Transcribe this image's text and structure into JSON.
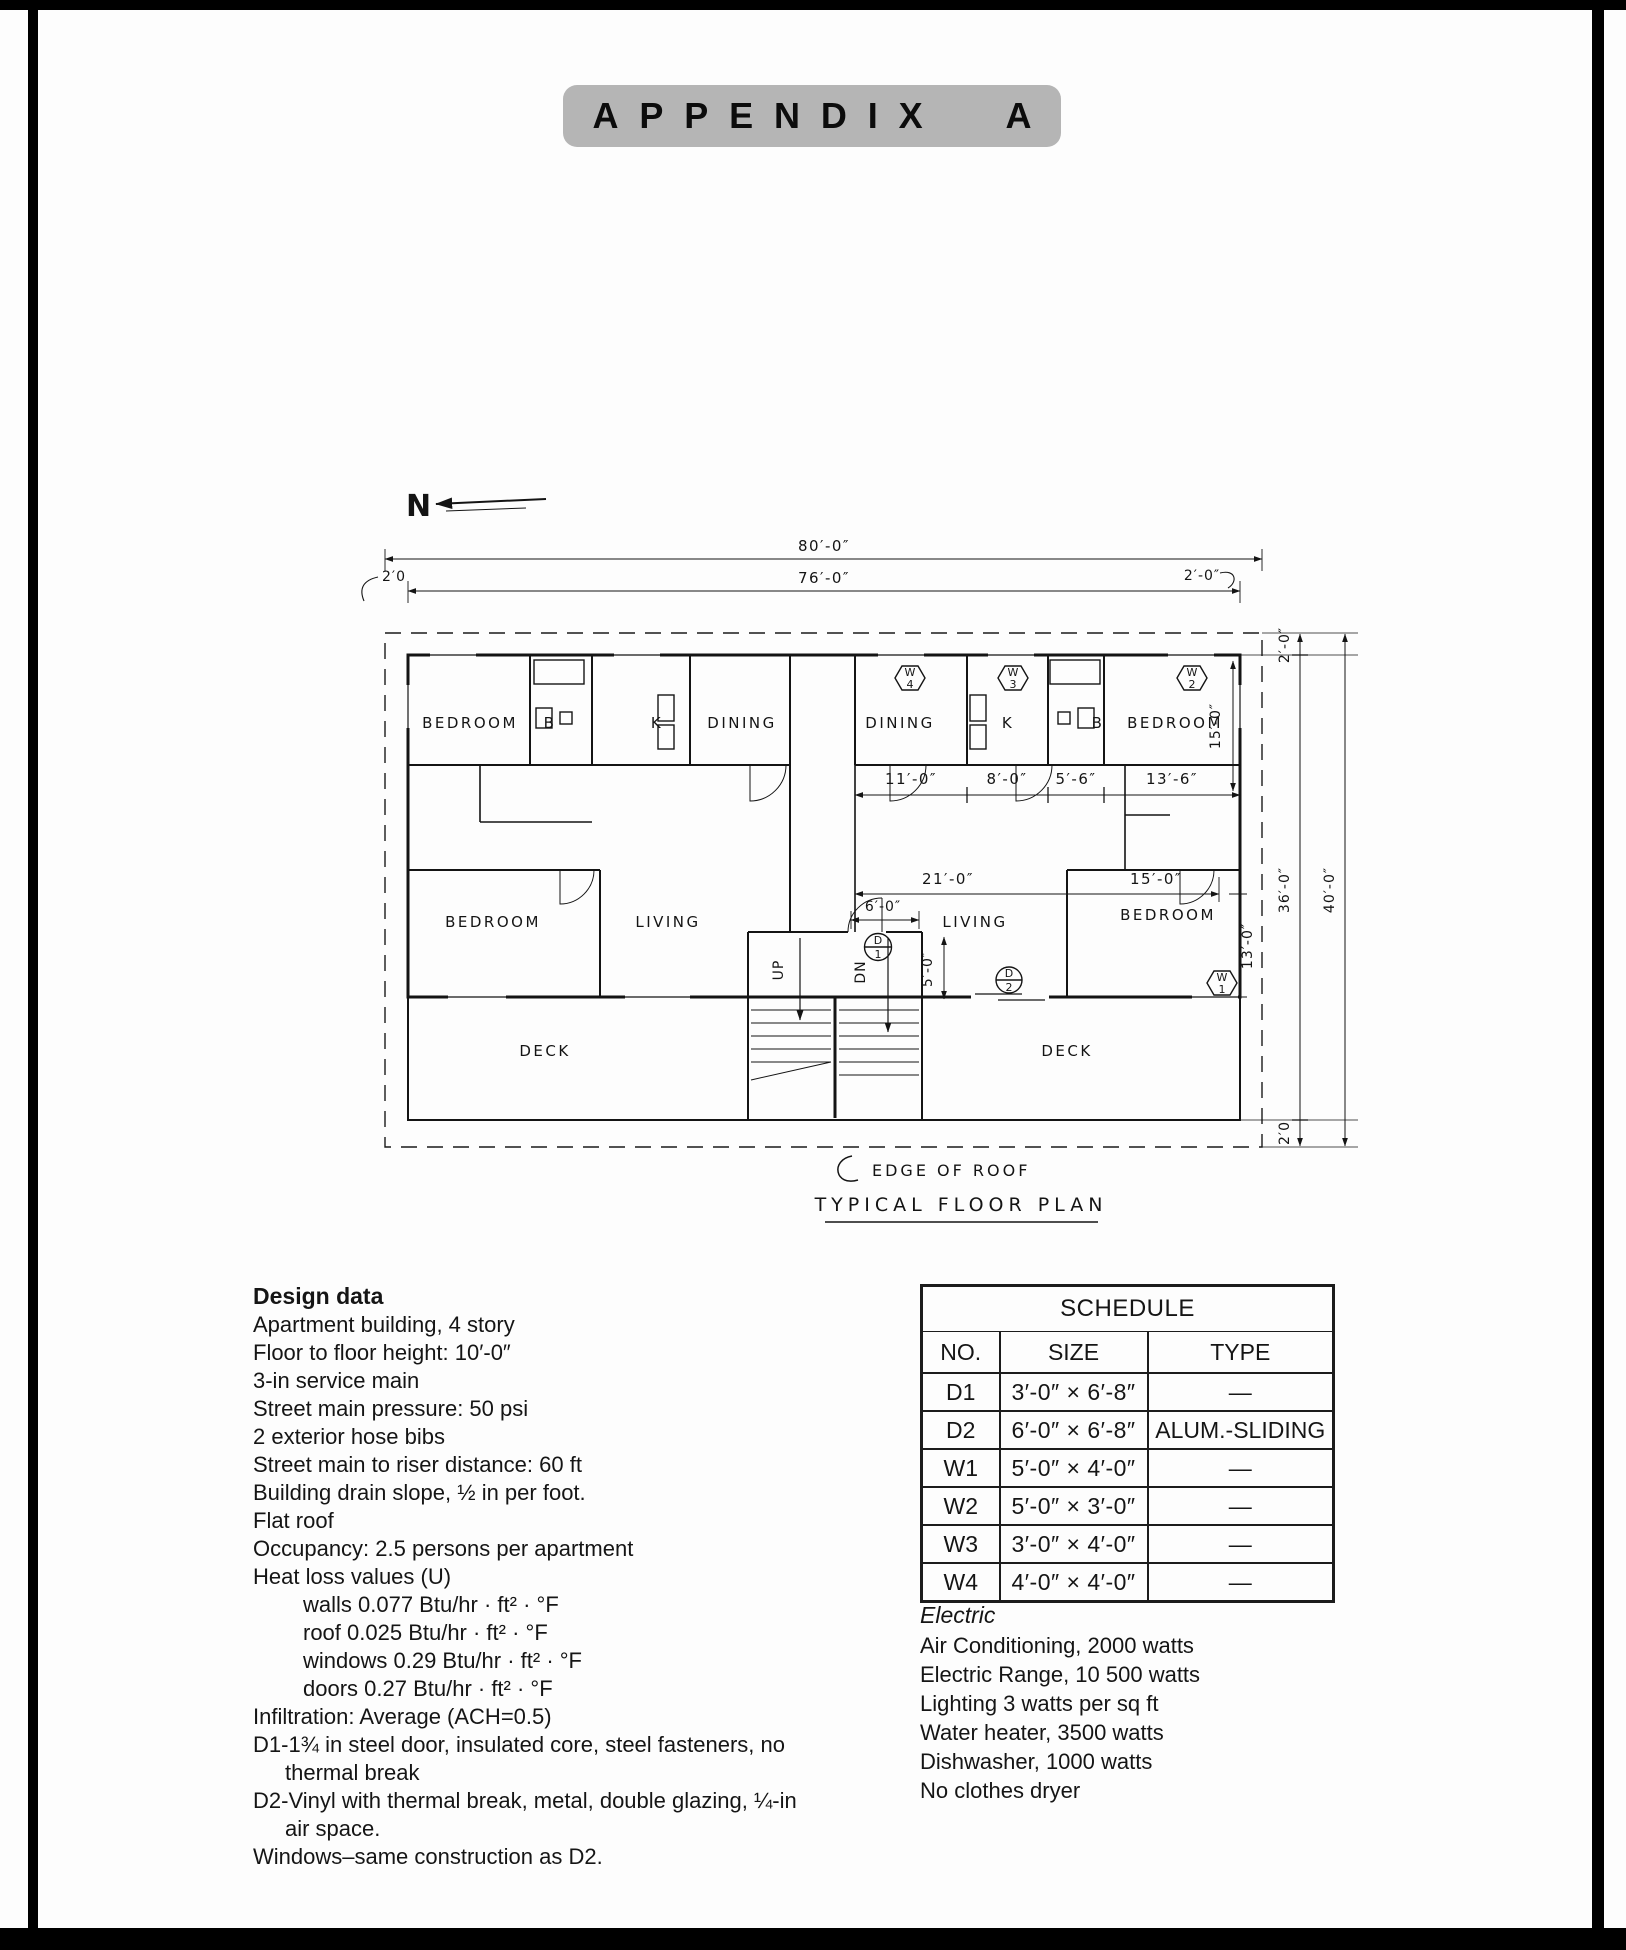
{
  "page": {
    "appendix_title": "APPENDIX A"
  },
  "plan": {
    "title": "TYPICAL FLOOR PLAN",
    "edge_of_roof": "EDGE OF ROOF",
    "north": "N",
    "labels": {
      "bedroom_nw": "BEDROOM",
      "bath_nw": "B",
      "kitchen_nw": "K",
      "dining_nw": "DINING",
      "dining_ne": "DINING",
      "kitchen_ne": "K",
      "bath_ne": "B",
      "bedroom_ne": "BEDROOM",
      "bedroom_sw": "BEDROOM",
      "living_sw": "LIVING",
      "living_se": "LIVING",
      "bedroom_se": "BEDROOM",
      "deck_sw": "DECK",
      "deck_se": "DECK",
      "up": "UP",
      "dn": "DN"
    },
    "dims": {
      "overall_width": "80′-0″",
      "interior_width": "76′-0″",
      "overhang_left": "2′0",
      "overhang_right": "2′-0″",
      "dining_ne": "11′-0″",
      "kitchen_ne": "8′-0″",
      "bath_ne": "5′-6″",
      "bedroom_ne": "13′-6″",
      "bedroom_ne_depth": "15′-0″",
      "living_se": "21′-0″",
      "bedroom_se": "15′-0″",
      "entry_width": "6′-0″",
      "entry_depth": "5′-0″",
      "bedroom_se_depth": "13′-0″",
      "overhang_top_right": "2′-0″",
      "building_depth": "36′-0″",
      "overall_depth": "40′-0″",
      "overhang_bottom_right": "2′0"
    },
    "symbols": {
      "w4": [
        "W",
        "4"
      ],
      "w3": [
        "W",
        "3"
      ],
      "w2": [
        "W",
        "2"
      ],
      "w1": [
        "W",
        "1"
      ],
      "d1": [
        "D",
        "1"
      ],
      "d2": [
        "D",
        "2"
      ]
    }
  },
  "design_data": {
    "heading": "Design data",
    "lines": [
      "Apartment building, 4 story",
      "Floor to floor height: 10′-0″",
      "3-in service main",
      "Street main pressure: 50 psi",
      "2 exterior hose bibs",
      "Street main to riser distance: 60 ft",
      "Building drain slope, ½ in per foot.",
      "Flat roof",
      "Occupancy: 2.5 persons per apartment",
      "Heat loss values (U)",
      "walls 0.077 Btu/hr · ft² · °F",
      "roof 0.025 Btu/hr · ft² · °F",
      "windows 0.29 Btu/hr · ft² · °F",
      "doors 0.27 Btu/hr · ft² · °F",
      "Infiltration: Average (ACH=0.5)",
      "D1-1¾ in steel door, insulated core, steel fasteners, no",
      "thermal break",
      "D2-Vinyl with thermal break, metal, double glazing, ¼-in",
      "air space.",
      "Windows–same construction as D2."
    ]
  },
  "schedule": {
    "title": "SCHEDULE",
    "columns": [
      "NO.",
      "SIZE",
      "TYPE"
    ],
    "rows": [
      {
        "no": "D1",
        "size": "3′-0″ × 6′-8″",
        "type": "—"
      },
      {
        "no": "D2",
        "size": "6′-0″ × 6′-8″",
        "type": "ALUM.-SLIDING"
      },
      {
        "no": "W1",
        "size": "5′-0″ × 4′-0″",
        "type": "—"
      },
      {
        "no": "W2",
        "size": "5′-0″ × 3′-0″",
        "type": "—"
      },
      {
        "no": "W3",
        "size": "3′-0″ × 4′-0″",
        "type": "—"
      },
      {
        "no": "W4",
        "size": "4′-0″ × 4′-0″",
        "type": "—"
      }
    ]
  },
  "electric": {
    "heading": "Electric",
    "lines": [
      "Air Conditioning, 2000 watts",
      "Electric Range, 10 500 watts",
      "Lighting 3 watts per sq ft",
      "Water heater, 3500 watts",
      "Dishwasher, 1000 watts",
      "No clothes dryer"
    ]
  }
}
